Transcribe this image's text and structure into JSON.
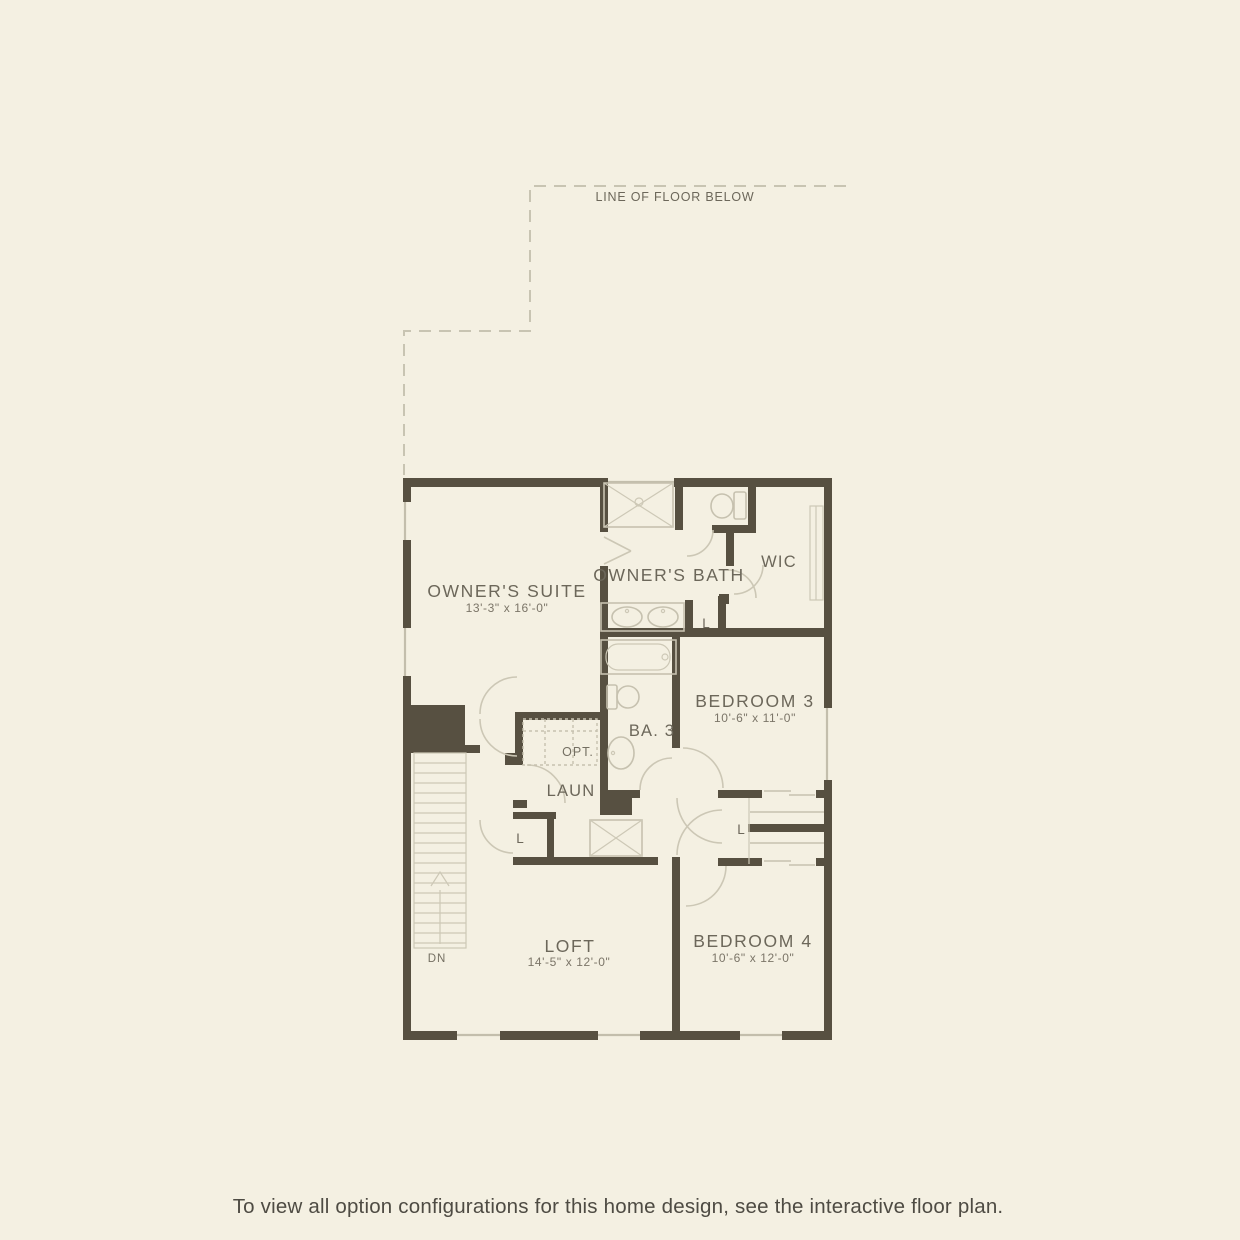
{
  "annotations": {
    "line_of_floor_below": "LINE OF FLOOR BELOW",
    "down": "DN",
    "optional": "OPT.",
    "linen_closet": "L"
  },
  "rooms": {
    "owners_suite": {
      "name": "OWNER'S SUITE",
      "dims": "13'-3\" x 16'-0\""
    },
    "owners_bath": {
      "name": "OWNER'S BATH"
    },
    "wic": {
      "name": "WIC"
    },
    "bedroom_3": {
      "name": "BEDROOM 3",
      "dims": "10'-6\" x 11'-0\""
    },
    "bath_3": {
      "name": "BA. 3"
    },
    "laundry": {
      "name": "LAUN"
    },
    "loft": {
      "name": "LOFT",
      "dims": "14'-5\" x 12'-0\""
    },
    "bedroom_4": {
      "name": "BEDROOM 4",
      "dims": "10'-6\" x 12'-0\""
    }
  },
  "footer": {
    "note": "To view all option configurations for this home design, see the interactive floor plan."
  },
  "colors": {
    "background": "#f4f0e2",
    "wall": "#575041",
    "fixture_line": "#c6c1af",
    "label_text": "#6c675a",
    "footer_text": "#4e4b43"
  }
}
